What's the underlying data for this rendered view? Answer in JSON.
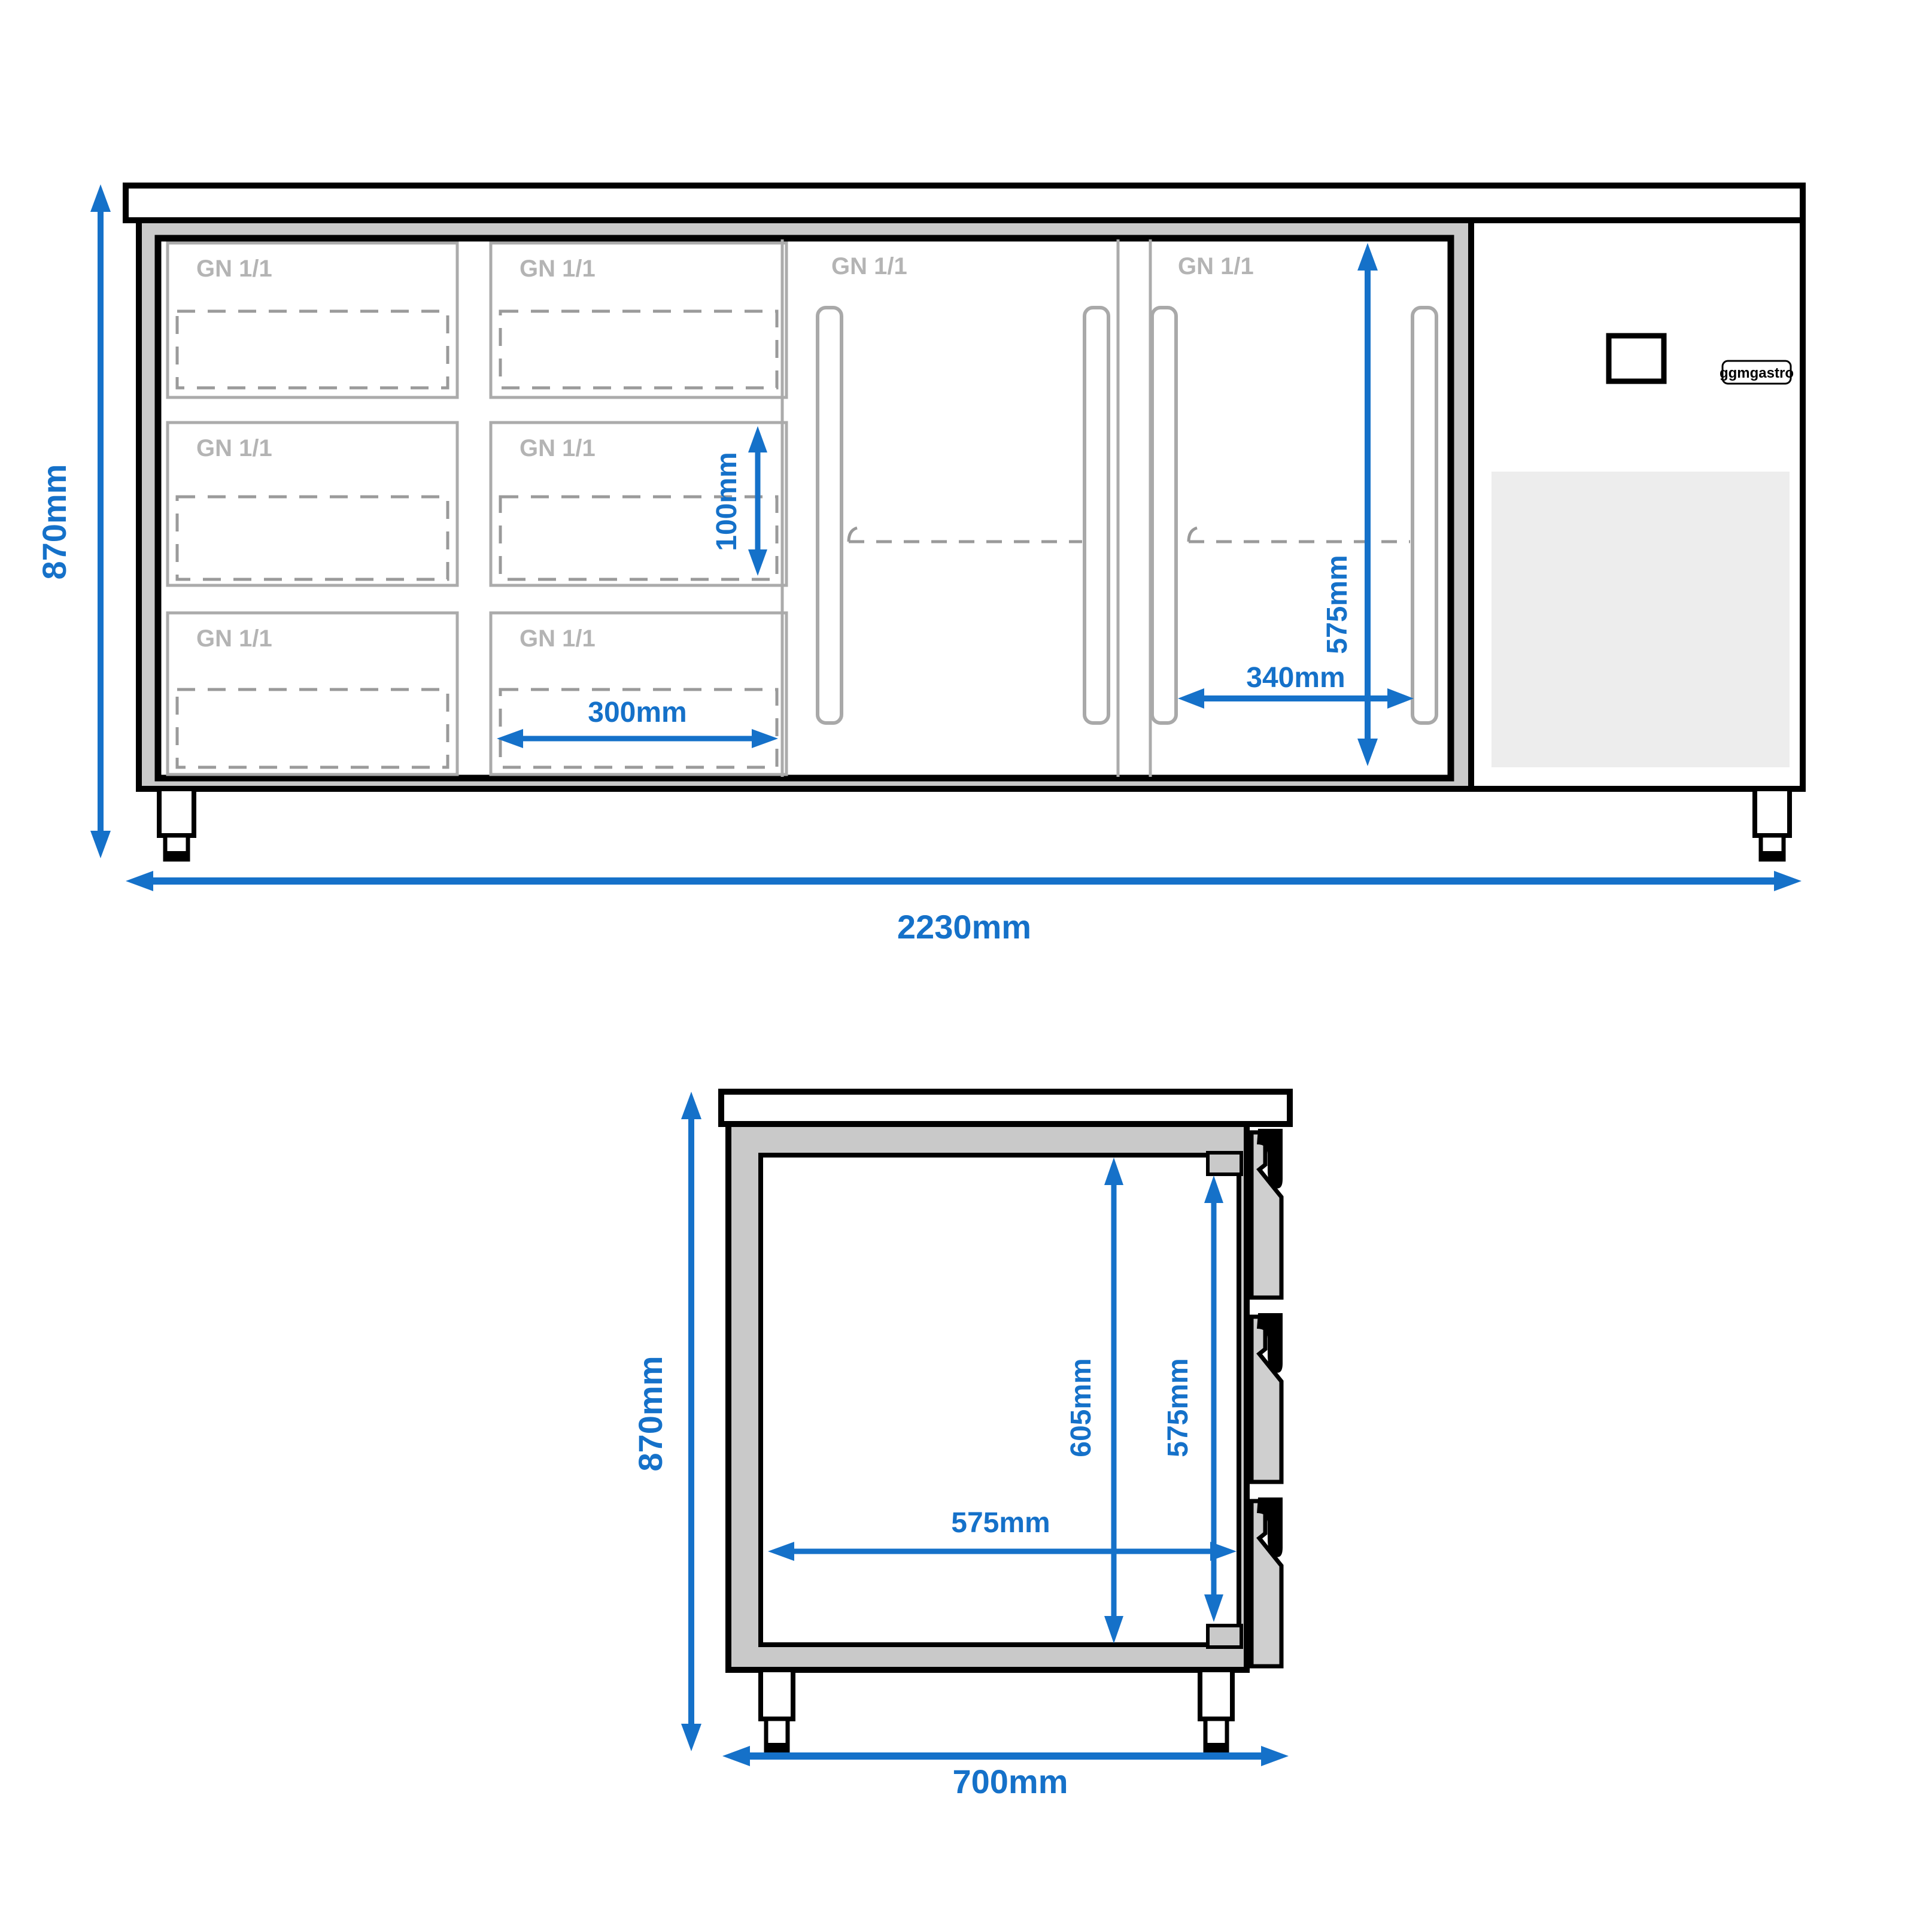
{
  "colors": {
    "dimension_blue": "#1571c9",
    "wall_gray": "#c9c9c9",
    "drawer_panel_gray": "#cfcfcf",
    "gn_outline_gray": "#ababab",
    "gn_label_gray": "#b4b4b4",
    "dashed_gray": "#9a9a9a",
    "vent_gray": "#ededed",
    "outline_black": "#000000"
  },
  "brand_badge": "ggmgastro",
  "front_view": {
    "gn_label": "GN 1/1",
    "height_dim": "870mm",
    "width_dim": "2230mm",
    "pan_depth_dim": "100mm",
    "pan_width_dim": "300mm",
    "door_inner_height_dim": "575mm",
    "door_shelf_width_dim": "340mm"
  },
  "side_view": {
    "height_dim": "870mm",
    "depth_dim": "700mm",
    "inner_height_dim": "605mm",
    "inner_rear_height_dim": "575mm",
    "inner_width_dim": "575mm"
  }
}
